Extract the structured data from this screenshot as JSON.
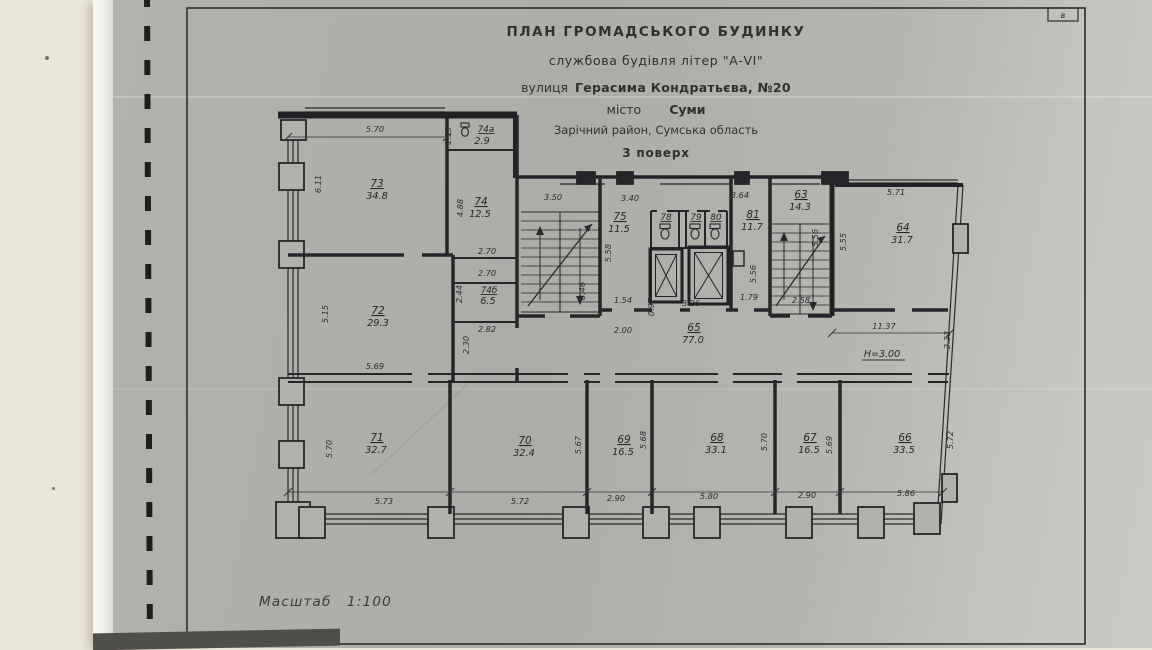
{
  "title_block": {
    "line1": "ПЛАН ГРОМАДСЬКОГО БУДИНКУ",
    "line2": "службова будівля літер \"А-VI\"",
    "street_label": "вулиця",
    "street_value": "Герасима Кондратьєва, №20",
    "city_label": "місто",
    "city_value": "Суми",
    "district": "Зарічний район, Сумська область",
    "floor": "3 поверх"
  },
  "scale_note": "Масштаб 1:100",
  "corner_mark": "в",
  "height_mark": "Н=3.00",
  "rooms": [
    {
      "number": "73",
      "area": "34.8"
    },
    {
      "number": "74а",
      "area": "2.9"
    },
    {
      "number": "74",
      "area": "12.5"
    },
    {
      "number": "74б",
      "area": "6.5"
    },
    {
      "number": "72",
      "area": "29.3"
    },
    {
      "number": "75",
      "area": "11.5"
    },
    {
      "number": "78"
    },
    {
      "number": "79"
    },
    {
      "number": "80"
    },
    {
      "number": "81",
      "area": "11.7"
    },
    {
      "number": "63",
      "area": "14.3"
    },
    {
      "number": "64",
      "area": "31.7"
    },
    {
      "number": "65",
      "area": "77.0"
    },
    {
      "number": "71",
      "area": "32.7"
    },
    {
      "number": "70",
      "area": "32.4"
    },
    {
      "number": "69",
      "area": "16.5"
    },
    {
      "number": "68",
      "area": "33.1"
    },
    {
      "number": "67",
      "area": "16.5"
    },
    {
      "number": "66",
      "area": "33.5"
    }
  ],
  "dims": {
    "top73": "5.70",
    "left73": "6.11",
    "w74a": "1.15",
    "h74": "4.88",
    "n270a": "2.70",
    "n270b": "2.70",
    "h74b": "2.44",
    "w74b": "2.82",
    "pass230": "2.30",
    "left72": "5.15",
    "w72": "5.69",
    "stairL_w": "3.50",
    "stairL_h": "8.46",
    "w75": "3.40",
    "h75": "5.58",
    "d154": "1.54",
    "d200": "2.00",
    "d097": "0.97",
    "d326": "3.26",
    "w81": "3.64",
    "h81": "5.56",
    "d179": "1.79",
    "w63": "2.58",
    "h63": "5.56",
    "top64": "5.71",
    "left64": "5.55",
    "right64": "2.33",
    "bottom64": "11.37",
    "left71": "5.70",
    "b71": "5.73",
    "b70": "5.72",
    "r70": "5.67",
    "b69": "2.90",
    "r69": "5.68",
    "b68": "5.80",
    "r68": "5.70",
    "b67": "2.90",
    "r67": "5.69",
    "b66": "5.86",
    "r66": "5.72"
  }
}
